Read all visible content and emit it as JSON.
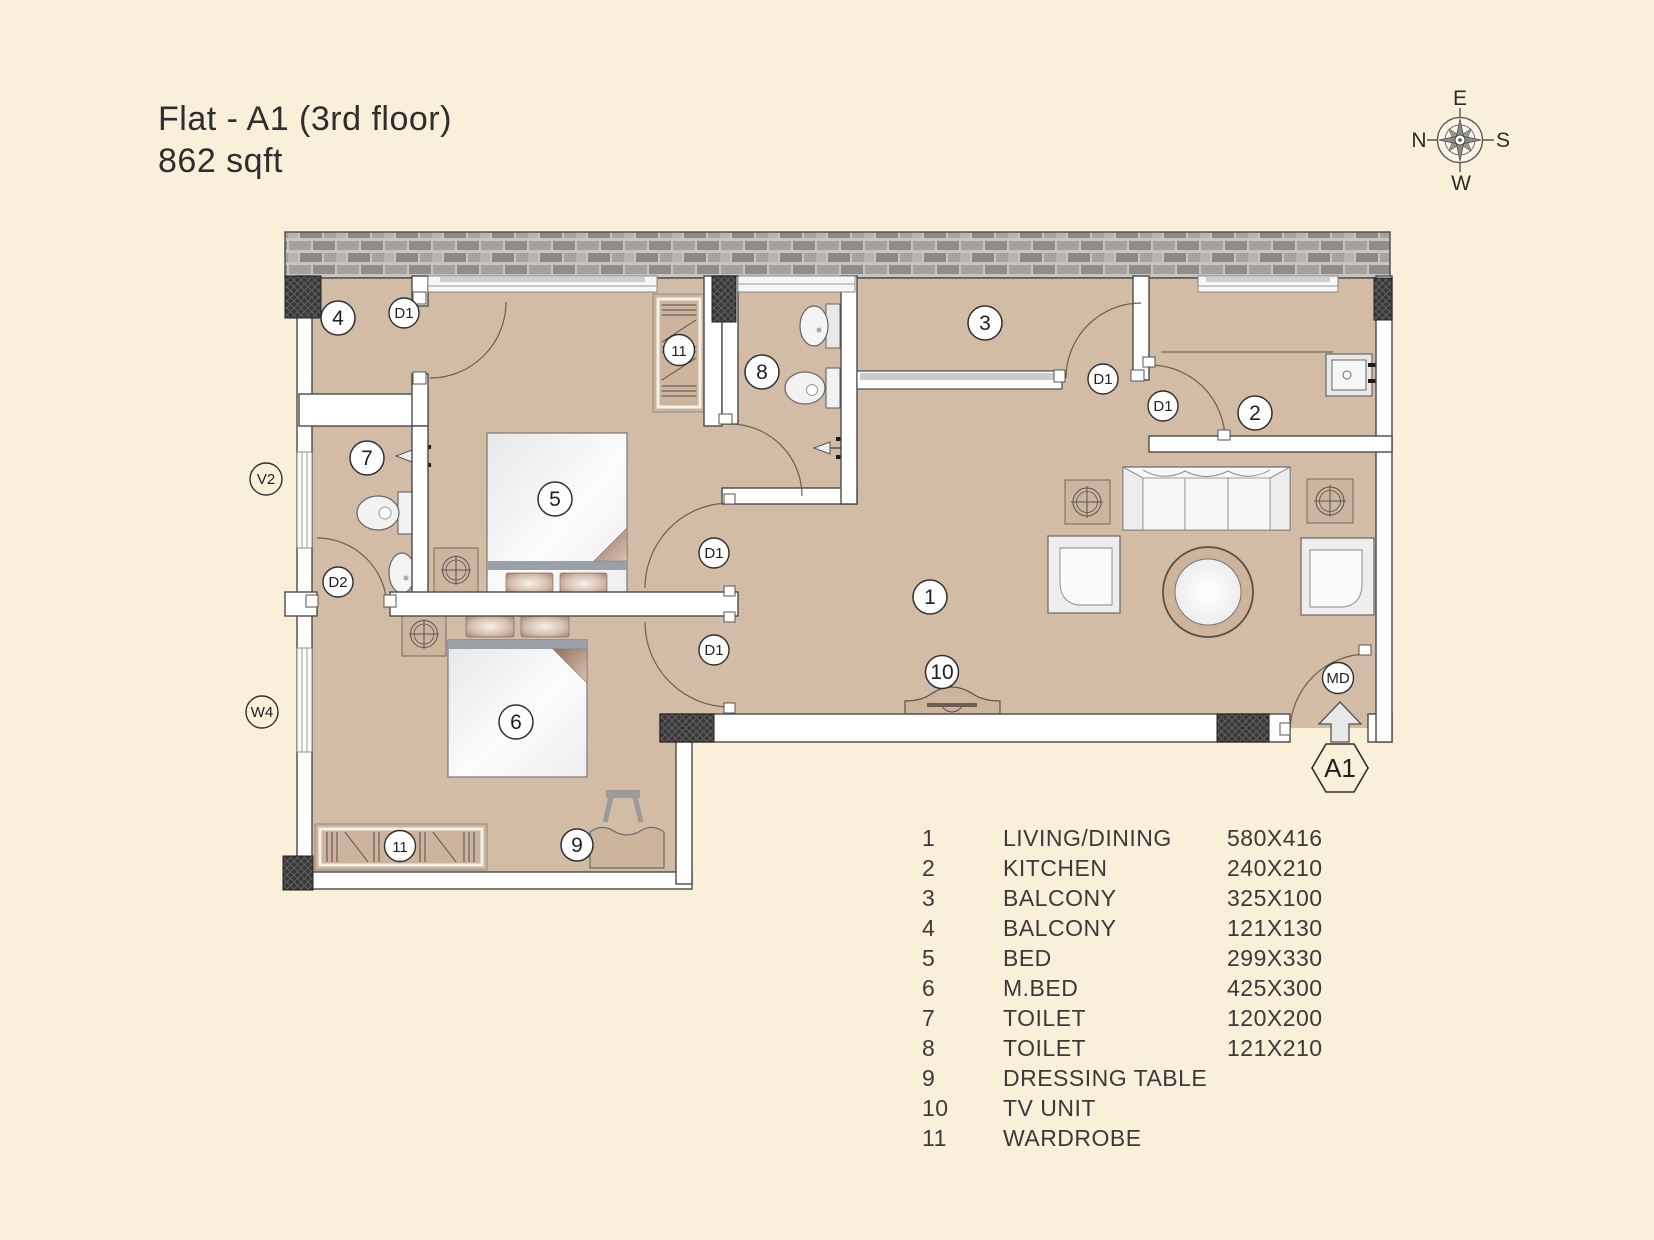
{
  "title": {
    "line1": "Flat - A1 (3rd floor)",
    "line2": "862 sqft"
  },
  "compass": {
    "top": "E",
    "right": "S",
    "bottom": "W",
    "left": "N"
  },
  "plan": {
    "labels": {
      "balcony4": "4",
      "d1_balcony4": "D1",
      "wardrobe_bed": "11",
      "toilet8": "8",
      "balcony3": "3",
      "d1_balcony3": "D1",
      "d1_kitchen": "D1",
      "kitchen": "2",
      "living": "1",
      "d1_bed": "D1",
      "d1_mbed": "D1",
      "tv": "10",
      "md": "MD",
      "bed": "5",
      "mbed": "6",
      "toilet7": "7",
      "d2_toilet7": "D2",
      "dressing": "9",
      "wardrobe_mbed": "11",
      "v2": "V2",
      "w4": "W4",
      "unit": "A1"
    }
  },
  "legend": {
    "rows": [
      {
        "num": "1",
        "name": "LIVING/DINING",
        "size": "580X416"
      },
      {
        "num": "2",
        "name": "KITCHEN",
        "size": "240X210"
      },
      {
        "num": "3",
        "name": "BALCONY",
        "size": "325X100"
      },
      {
        "num": "4",
        "name": "BALCONY",
        "size": "121X130"
      },
      {
        "num": "5",
        "name": "BED",
        "size": "299X330"
      },
      {
        "num": "6",
        "name": "M.BED",
        "size": "425X300"
      },
      {
        "num": "7",
        "name": "TOILET",
        "size": "120X200"
      },
      {
        "num": "8",
        "name": "TOILET",
        "size": "121X210"
      },
      {
        "num": "9",
        "name": "DRESSING TABLE",
        "size": ""
      },
      {
        "num": "10",
        "name": "TV UNIT",
        "size": ""
      },
      {
        "num": "11",
        "name": "WARDROBE",
        "size": ""
      }
    ]
  },
  "colors": {
    "background": "#FAEFD9",
    "floor": "#D3BCA5",
    "wall_stroke": "#4A4A4A",
    "brick": "#A5A29D",
    "label_ink": "#1F1F1F"
  }
}
